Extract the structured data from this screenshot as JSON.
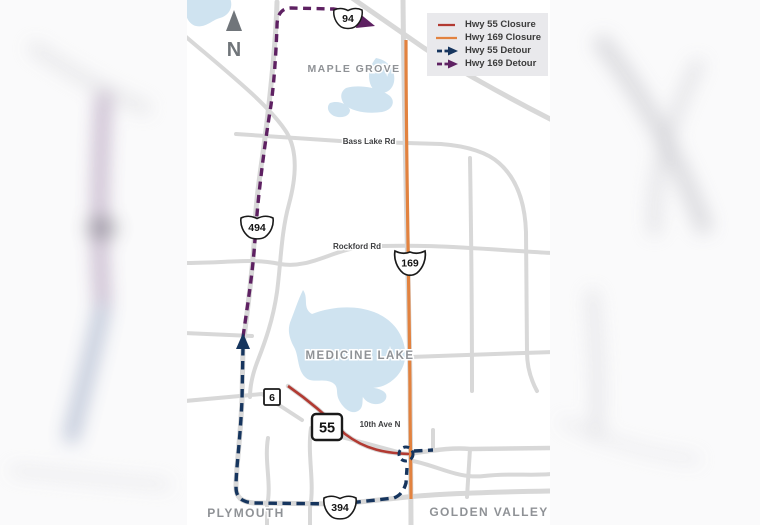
{
  "legend": {
    "items": [
      {
        "label": "Hwy 55 Closure"
      },
      {
        "label": "Hwy 169 Closure"
      },
      {
        "label": "Hwy 55 Detour"
      },
      {
        "label": "Hwy 169 Detour"
      }
    ]
  },
  "map": {
    "north": "N",
    "cities": {
      "maple_grove": "MAPLE GROVE",
      "medicine_lake": "MEDICINE LAKE",
      "plymouth": "PLYMOUTH",
      "golden_valley": "GOLDEN VALLEY"
    },
    "streets": {
      "bass_lake": "Bass Lake Rd",
      "rockford": "Rockford Rd",
      "tenth_ave": "10th Ave N"
    },
    "shields": {
      "i94": "94",
      "i494": "494",
      "i394": "394",
      "us169": "169",
      "mn55": "55",
      "cr6": "6"
    }
  },
  "colors": {
    "closure_55": "#b23a32",
    "closure_169": "#e2823f",
    "detour_55": "#16355e",
    "detour_169": "#5e2162"
  }
}
